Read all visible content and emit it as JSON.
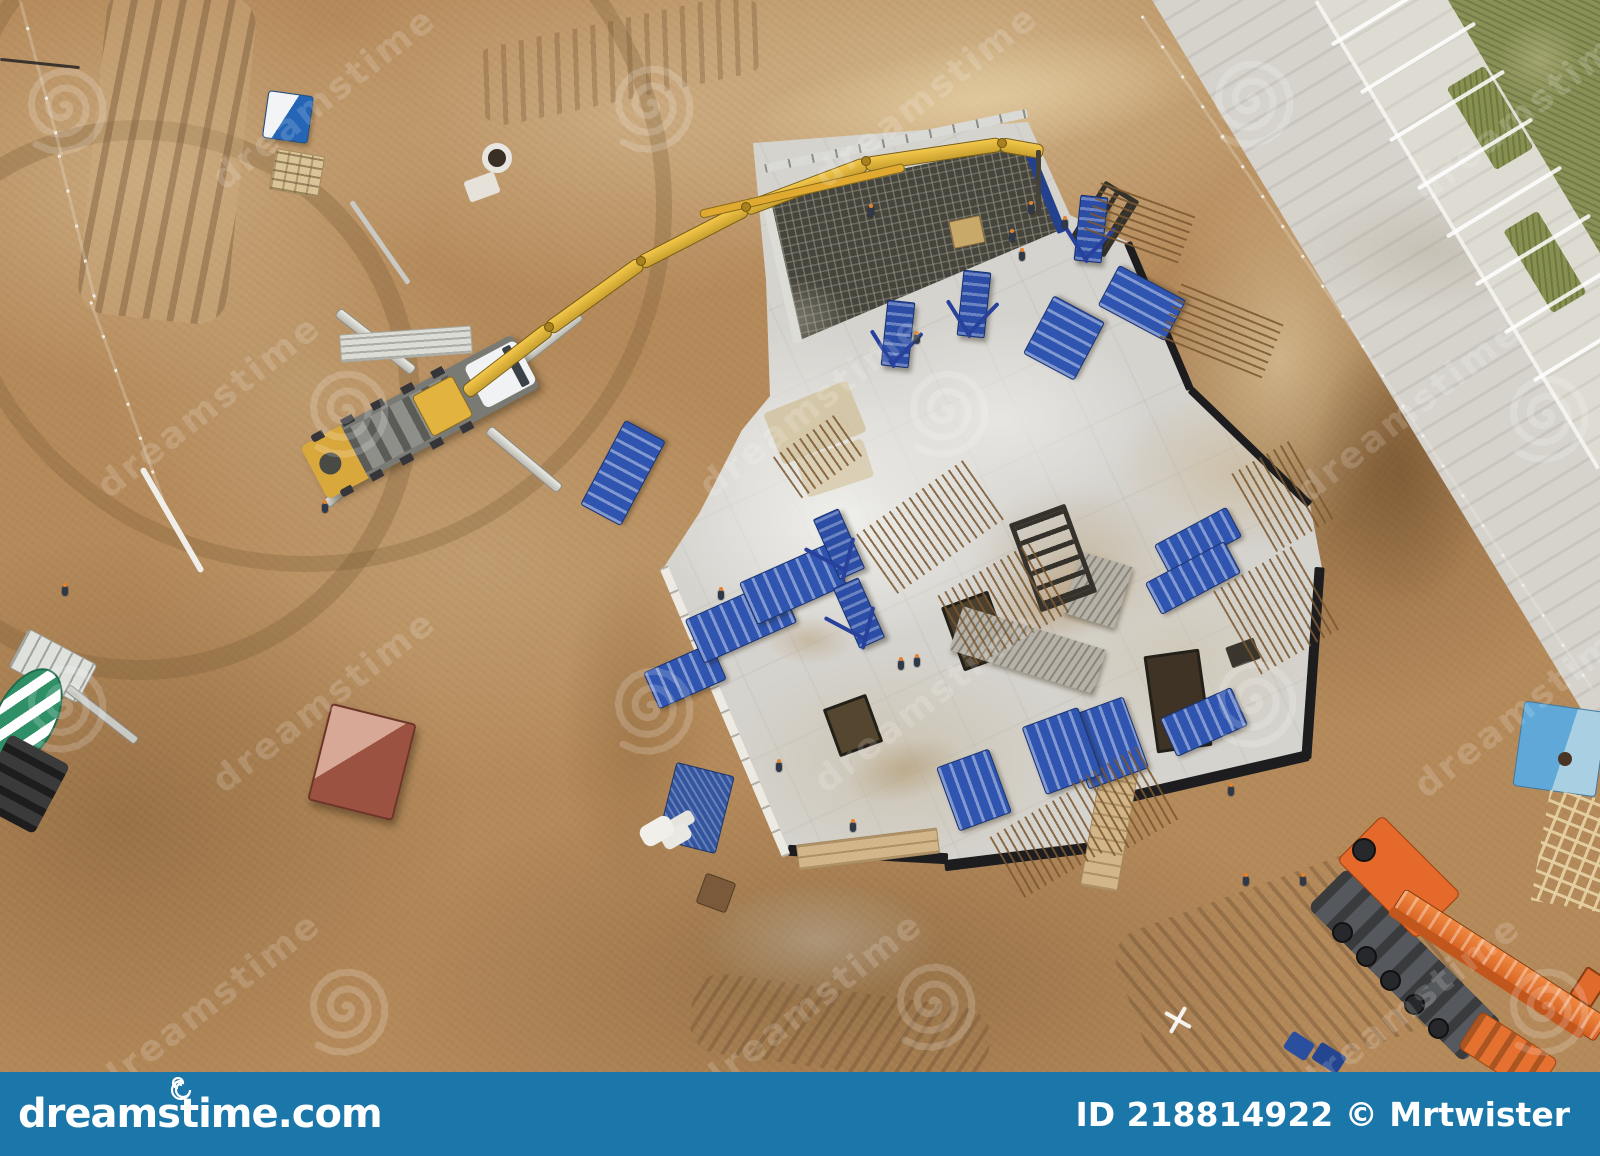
{
  "footer": {
    "site": "dreamstime.com",
    "credit": "ID 218814922 © Mrtwister"
  },
  "watermark": {
    "text": "dreamstime"
  },
  "colors": {
    "footer_bar": "#1b76a9",
    "dirt": "#b58a5a",
    "concrete_slab": "#d5d3ce",
    "formwork_blue": "#2f55b0",
    "pump_boom_yellow": "#edb93c",
    "crane_orange": "#e4692b",
    "road_gray": "#d6d3cc",
    "grass_green": "#8a9156",
    "mixer_drum_green": "#2f9068",
    "toilet_blue": "#2465b5"
  }
}
